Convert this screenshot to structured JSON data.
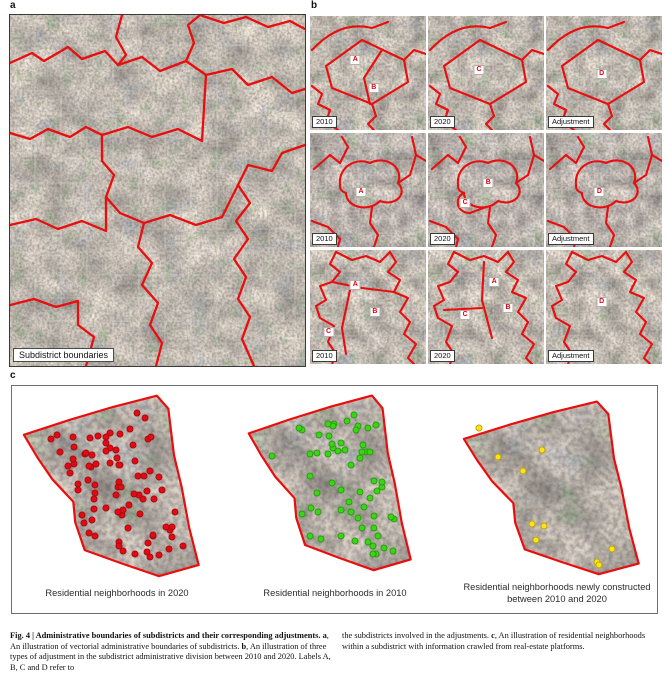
{
  "figure": {
    "panel_a": {
      "label": "a",
      "badge": "Subdistrict boundaries"
    },
    "panel_b": {
      "label": "b",
      "rows": [
        {
          "tiles": [
            {
              "tag": "2010",
              "markers": [
                {
                  "t": "A",
                  "x": 39,
                  "y": 39
                },
                {
                  "t": "B",
                  "x": 55,
                  "y": 63
                }
              ]
            },
            {
              "tag": "2020",
              "markers": [
                {
                  "t": "C",
                  "x": 44,
                  "y": 47
                }
              ]
            },
            {
              "tag": "Adjustment",
              "markers": [
                {
                  "t": "D",
                  "x": 48,
                  "y": 51
                }
              ]
            }
          ]
        },
        {
          "tiles": [
            {
              "tag": "2010",
              "markers": [
                {
                  "t": "A",
                  "x": 44,
                  "y": 52
                }
              ]
            },
            {
              "tag": "2020",
              "markers": [
                {
                  "t": "B",
                  "x": 52,
                  "y": 44
                },
                {
                  "t": "C",
                  "x": 32,
                  "y": 61
                }
              ]
            },
            {
              "tag": "Adjustment",
              "markers": [
                {
                  "t": "D",
                  "x": 46,
                  "y": 52
                }
              ]
            }
          ]
        },
        {
          "tiles": [
            {
              "tag": "2010",
              "markers": [
                {
                  "t": "A",
                  "x": 39,
                  "y": 31
                },
                {
                  "t": "B",
                  "x": 56,
                  "y": 54
                },
                {
                  "t": "C",
                  "x": 16,
                  "y": 72
                }
              ]
            },
            {
              "tag": "2020",
              "markers": [
                {
                  "t": "A",
                  "x": 57,
                  "y": 28
                },
                {
                  "t": "B",
                  "x": 69,
                  "y": 51
                },
                {
                  "t": "C",
                  "x": 32,
                  "y": 57
                }
              ]
            },
            {
              "tag": "Adjustment",
              "markers": [
                {
                  "t": "D",
                  "x": 48,
                  "y": 46
                }
              ]
            }
          ]
        }
      ]
    },
    "panel_c": {
      "label": "c",
      "maps": [
        {
          "caption": "Residential neighborhoods in 2020",
          "dot_color": "#e30b13",
          "dot_count": 85,
          "seed": 5
        },
        {
          "caption": "Residential neighborhoods in 2010",
          "dot_color": "#3bd416",
          "dot_count": 62,
          "seed": 9
        },
        {
          "caption": "Residential neighborhoods newly constructed between 2010 and 2020",
          "dot_color": "#ffe316",
          "dots": [
            [
              9,
              17
            ],
            [
              42,
              29
            ],
            [
              19,
              33
            ],
            [
              32,
              41
            ],
            [
              37,
              71
            ],
            [
              43,
              72
            ],
            [
              39,
              80
            ],
            [
              79,
              85
            ],
            [
              71,
              92
            ],
            [
              72,
              94
            ]
          ]
        }
      ]
    },
    "colors": {
      "boundary_red": "#e90e0e",
      "marker_red": "#e8000d"
    },
    "caption": {
      "left": [
        {
          "t": "Fig. 4 | Administrative boundaries of subdistricts and their corresponding adjustments. ",
          "b": true
        },
        {
          "t": "a",
          "b": true
        },
        {
          "t": ", An illustration of vectorial administrative boundaries of subdistricts. ",
          "b": false
        },
        {
          "t": "b",
          "b": true
        },
        {
          "t": ", An illustration of three types of adjustment in the subdistrict administrative division between 2010 and 2020. Labels A, B, C and D refer to",
          "b": false
        }
      ],
      "right": [
        {
          "t": "the subdistricts involved in the adjustments. ",
          "b": false
        },
        {
          "t": "c",
          "b": true
        },
        {
          "t": ", An illustration of residential neighborhoods within a subdistrict with information crawled from real-estate platforms.",
          "b": false
        }
      ]
    }
  }
}
